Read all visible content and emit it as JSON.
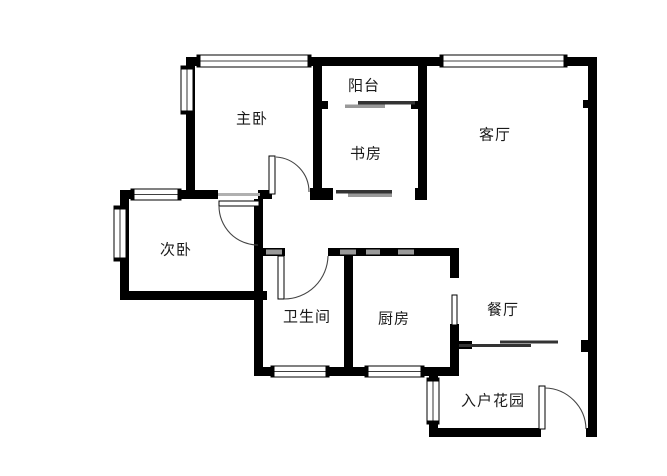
{
  "floorplan": {
    "canvas": {
      "width": 667,
      "height": 476
    },
    "colors": {
      "wall": "#000000",
      "hatch": "#9a9a9a",
      "arc": "#444444",
      "leaf_fill": "#ffffff",
      "leaf_stroke": "#000000",
      "slider_dark": "#333333",
      "slider_light": "#999999",
      "lintel": "#b0b0b0",
      "label": "#1a1a1a",
      "background": "#ffffff"
    },
    "label_font_size": 15,
    "rooms": [
      {
        "id": "master-bedroom",
        "label": "主卧",
        "cx": 252,
        "cy": 118
      },
      {
        "id": "balcony",
        "label": "阳台",
        "cx": 364,
        "cy": 85
      },
      {
        "id": "study",
        "label": "书房",
        "cx": 366,
        "cy": 153
      },
      {
        "id": "living-room",
        "label": "客厅",
        "cx": 495,
        "cy": 134
      },
      {
        "id": "second-bedroom",
        "label": "次卧",
        "cx": 176,
        "cy": 249
      },
      {
        "id": "bathroom",
        "label": "卫生间",
        "cx": 307,
        "cy": 316
      },
      {
        "id": "kitchen",
        "label": "厨房",
        "cx": 394,
        "cy": 318
      },
      {
        "id": "dining-room",
        "label": "餐厅",
        "cx": 503,
        "cy": 309
      },
      {
        "id": "entry-garden",
        "label": "入户花园",
        "cx": 493,
        "cy": 400
      }
    ],
    "walls": [
      [
        186,
        57,
        411,
        9
      ],
      [
        186,
        57,
        9,
        141
      ],
      [
        120,
        190,
        98,
        9
      ],
      [
        258,
        190,
        14,
        9
      ],
      [
        310,
        188,
        23,
        12
      ],
      [
        313,
        59,
        9,
        131
      ],
      [
        313,
        101,
        15,
        8
      ],
      [
        411,
        101,
        9,
        8
      ],
      [
        418,
        59,
        9,
        141
      ],
      [
        415,
        188,
        12,
        12
      ],
      [
        588,
        57,
        9,
        380
      ],
      [
        583,
        100,
        5,
        8
      ],
      [
        120,
        190,
        9,
        110
      ],
      [
        120,
        291,
        147,
        9
      ],
      [
        254,
        199,
        9,
        177
      ],
      [
        254,
        248,
        31,
        8
      ],
      [
        328,
        248,
        131,
        8
      ],
      [
        344,
        256,
        9,
        119
      ],
      [
        450,
        248,
        9,
        30
      ],
      [
        450,
        324,
        9,
        51
      ],
      [
        254,
        367,
        205,
        9
      ],
      [
        458,
        341,
        14,
        8
      ],
      [
        581,
        340,
        7,
        12
      ],
      [
        429,
        371,
        9,
        66
      ],
      [
        429,
        428,
        112,
        9
      ],
      [
        586,
        428,
        11,
        9
      ]
    ],
    "hatches": [
      [
        266,
        249.5,
        16,
        5
      ],
      [
        340,
        249.5,
        16,
        5
      ],
      [
        366,
        249.5,
        14,
        5
      ],
      [
        398,
        249.5,
        16,
        5
      ]
    ],
    "windows": [
      {
        "x": 197,
        "y": 55,
        "w": 114,
        "h": 12,
        "dir": "h"
      },
      {
        "x": 440,
        "y": 55,
        "w": 127,
        "h": 12,
        "dir": "h"
      },
      {
        "x": 131,
        "y": 189,
        "w": 50,
        "h": 11,
        "dir": "h"
      },
      {
        "x": 271,
        "y": 366,
        "w": 58,
        "h": 11,
        "dir": "h"
      },
      {
        "x": 365,
        "y": 366,
        "w": 59,
        "h": 11,
        "dir": "h"
      },
      {
        "x": 181,
        "y": 66,
        "w": 12,
        "h": 48,
        "dir": "v"
      },
      {
        "x": 114,
        "y": 206,
        "w": 12,
        "h": 55,
        "dir": "v"
      },
      {
        "x": 427,
        "y": 378,
        "w": 12,
        "h": 46,
        "dir": "v"
      }
    ],
    "sliders": [
      {
        "x": 358,
        "y": 101,
        "w": 57,
        "h": 3.5,
        "tone": "dark"
      },
      {
        "x": 345,
        "y": 104.5,
        "w": 40,
        "h": 3.5,
        "tone": "light"
      },
      {
        "x": 336,
        "y": 190,
        "w": 56,
        "h": 3.5,
        "tone": "dark"
      },
      {
        "x": 348,
        "y": 193.5,
        "w": 44,
        "h": 3.5,
        "tone": "light"
      },
      {
        "x": 459,
        "y": 344,
        "w": 72,
        "h": 3,
        "tone": "dark"
      },
      {
        "x": 500,
        "y": 340.5,
        "w": 58,
        "h": 3,
        "tone": "dark"
      }
    ],
    "lintels": [
      [
        218,
        193,
        42,
        3
      ]
    ],
    "door_leaves": [
      {
        "id": "master-bedroom-door-leaf",
        "x": 269,
        "y": 156,
        "w": 6,
        "h": 38
      },
      {
        "id": "second-bedroom-door-leaf",
        "x": 219,
        "y": 201,
        "w": 40,
        "h": 5
      },
      {
        "id": "bathroom-door-leaf",
        "x": 278,
        "y": 256,
        "w": 6,
        "h": 43
      },
      {
        "id": "kitchen-door-leaf",
        "x": 452,
        "y": 295,
        "w": 5,
        "h": 30
      },
      {
        "id": "entry-door-leaf",
        "x": 539,
        "y": 386,
        "w": 6,
        "h": 43
      }
    ],
    "door_arcs": [
      {
        "id": "master-bedroom-door-arc",
        "d": "M 276 157 A 35 35 0 0 1 309 192"
      },
      {
        "id": "second-bedroom-door-arc",
        "d": "M 219 206 A 39 39 0 0 0 258 245"
      },
      {
        "id": "bathroom-door-arc",
        "d": "M 328 256 A 44 44 0 0 1 284 299"
      },
      {
        "id": "entry-door-arc",
        "d": "M 545 388 A 42 42 0 0 1 586 429"
      }
    ]
  }
}
